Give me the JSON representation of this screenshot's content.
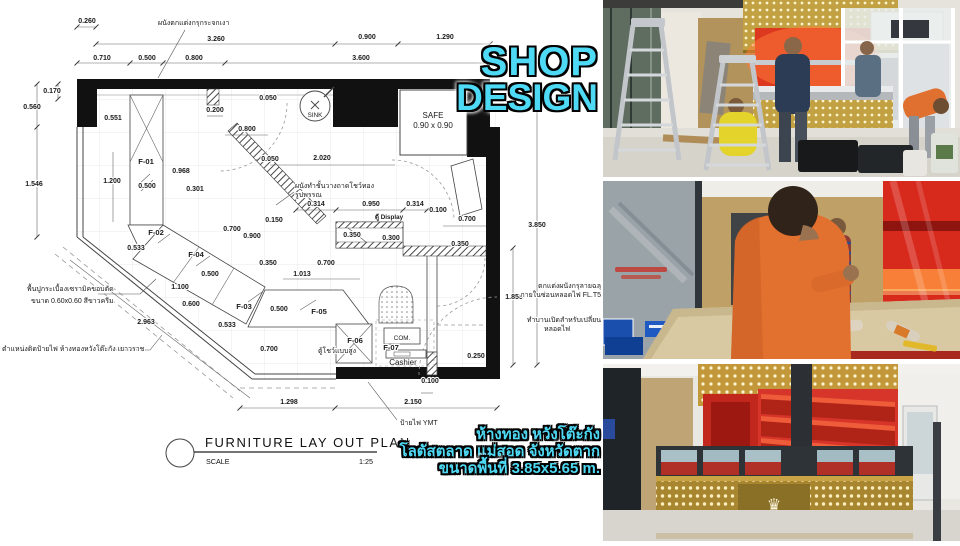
{
  "overlay": {
    "title_line1": "SHOP",
    "title_line2": "DESIGN",
    "caption_lines": [
      "ห้างทอง หวังโต๊ะกัง",
      "โลตัสตลาด แม่สอด จังหวัดตาก",
      "ขนาดพื้นที่ 3.85x5.65 m."
    ]
  },
  "colors": {
    "accent_cyan": "#4ed9f4",
    "outline_black": "#000000",
    "wall_black": "#111111",
    "red_panel": "#d8351f",
    "gold_panel": "#c19a3f"
  },
  "plan": {
    "texts": {
      "title": "FURNITURE LAY OUT PLAN",
      "scale_label": "SCALE",
      "scale_value": "1:25",
      "safe_line1": "SAFE",
      "safe_line2": "0.90 x 0.90",
      "sink": "SINK",
      "com": "COM.",
      "cashier": "Cashier",
      "display_cabinet": "ตู้ Display"
    },
    "dim_labels": [
      {
        "t": "0.260",
        "x": 87,
        "y": 23
      },
      {
        "t": "3.260",
        "x": 216,
        "y": 41
      },
      {
        "t": "0.900",
        "x": 367,
        "y": 39
      },
      {
        "t": "1.290",
        "x": 445,
        "y": 39
      },
      {
        "t": "0.710",
        "x": 102,
        "y": 60
      },
      {
        "t": "0.500",
        "x": 147,
        "y": 60
      },
      {
        "t": "0.800",
        "x": 194,
        "y": 60
      },
      {
        "t": "3.600",
        "x": 361,
        "y": 60
      },
      {
        "t": "0.170",
        "x": 52,
        "y": 93
      },
      {
        "t": "0.560",
        "x": 32,
        "y": 109
      },
      {
        "t": "0.551",
        "x": 113,
        "y": 120
      },
      {
        "t": "1.546",
        "x": 34,
        "y": 186
      },
      {
        "t": "1.200",
        "x": 112,
        "y": 183
      },
      {
        "t": "0.050",
        "x": 268,
        "y": 100
      },
      {
        "t": "0.200",
        "x": 215,
        "y": 112
      },
      {
        "t": "0.800",
        "x": 247,
        "y": 131
      },
      {
        "t": "0.050",
        "x": 270,
        "y": 161
      },
      {
        "t": "2.020",
        "x": 322,
        "y": 160
      },
      {
        "t": "0.968",
        "x": 181,
        "y": 173
      },
      {
        "t": "0.500",
        "x": 147,
        "y": 188
      },
      {
        "t": "0.301",
        "x": 195,
        "y": 191
      },
      {
        "t": "0.150",
        "x": 274,
        "y": 222
      },
      {
        "t": "0.314",
        "x": 316,
        "y": 206
      },
      {
        "t": "0.950",
        "x": 371,
        "y": 206
      },
      {
        "t": "0.314",
        "x": 415,
        "y": 206
      },
      {
        "t": "0.100",
        "x": 438,
        "y": 212
      },
      {
        "t": "0.700",
        "x": 467,
        "y": 221
      },
      {
        "t": "0.350",
        "x": 352,
        "y": 237
      },
      {
        "t": "0.300",
        "x": 391,
        "y": 240
      },
      {
        "t": "3.850",
        "x": 537,
        "y": 227
      },
      {
        "t": "0.350",
        "x": 460,
        "y": 246
      },
      {
        "t": "0.533",
        "x": 136,
        "y": 250
      },
      {
        "t": "0.700",
        "x": 232,
        "y": 231
      },
      {
        "t": "0.900",
        "x": 252,
        "y": 238
      },
      {
        "t": "0.350",
        "x": 268,
        "y": 265
      },
      {
        "t": "0.700",
        "x": 326,
        "y": 265
      },
      {
        "t": "1.013",
        "x": 302,
        "y": 276
      },
      {
        "t": "0.500",
        "x": 210,
        "y": 276
      },
      {
        "t": "1.100",
        "x": 180,
        "y": 289
      },
      {
        "t": "0.600",
        "x": 191,
        "y": 306
      },
      {
        "t": "0.533",
        "x": 227,
        "y": 327
      },
      {
        "t": "0.500",
        "x": 279,
        "y": 311
      },
      {
        "t": "1.850",
        "x": 514,
        "y": 299
      },
      {
        "t": "0.700",
        "x": 269,
        "y": 351
      },
      {
        "t": "0.250",
        "x": 476,
        "y": 358
      },
      {
        "t": "0.100",
        "x": 430,
        "y": 383
      },
      {
        "t": "1.298",
        "x": 289,
        "y": 404
      },
      {
        "t": "2.150",
        "x": 413,
        "y": 404
      },
      {
        "t": "2.963",
        "x": 146,
        "y": 324
      }
    ],
    "furniture_labels": [
      {
        "t": "F-01",
        "x": 146,
        "y": 164
      },
      {
        "t": "F-02",
        "x": 156,
        "y": 235
      },
      {
        "t": "F-04",
        "x": 196,
        "y": 257
      },
      {
        "t": "F-03",
        "x": 244,
        "y": 309
      },
      {
        "t": "F-05",
        "x": 319,
        "y": 314
      },
      {
        "t": "F-06",
        "x": 355,
        "y": 343
      },
      {
        "t": "F-07",
        "x": 391,
        "y": 350
      }
    ],
    "annotations": [
      {
        "t": "ผนังตกแต่งกรุกระจกเงา",
        "x": 158,
        "y": 25,
        "a": "start"
      },
      {
        "t": "ผนังทำชั้นวางถาดโชว์ทอง",
        "x": 295,
        "y": 188,
        "a": "start"
      },
      {
        "t": "รูปพรรณ",
        "x": 295,
        "y": 197,
        "a": "start"
      },
      {
        "t": "ตกแต่งผนังกรุลายฉลุ",
        "x": 601,
        "y": 288,
        "a": "end"
      },
      {
        "t": "ภายในซ่อนหลอดไฟ FL.T5",
        "x": 601,
        "y": 297,
        "a": "end"
      },
      {
        "t": "ทำบานเปิดสำหรับเปลี่ยน",
        "x": 601,
        "y": 322,
        "a": "end"
      },
      {
        "t": "หลอดไฟ",
        "x": 544,
        "y": 331,
        "a": "start"
      },
      {
        "t": "ตู้โชว์แบบสูง",
        "x": 318,
        "y": 353,
        "a": "start"
      },
      {
        "t": "ป้ายไฟ YMT",
        "x": 400,
        "y": 425,
        "a": "start"
      },
      {
        "t": "ตำแหน่งติดป้ายไฟ ห้างทองหวังโต๊ะกัง เยาวราช",
        "x": 2,
        "y": 351,
        "a": "start"
      },
      {
        "t": "พื้นปูกระเบื้องเซรามิคขอบตัด",
        "x": 27,
        "y": 291,
        "a": "start"
      },
      {
        "t": "ขนาด 0.60x0.60 สีขาวครีม",
        "x": 31,
        "y": 303,
        "a": "start"
      }
    ]
  },
  "photos": {
    "items": [
      {
        "name": "shop-under-construction-overview"
      },
      {
        "name": "counter-installation-detail"
      },
      {
        "name": "finished-gold-shop-kiosk"
      }
    ]
  }
}
